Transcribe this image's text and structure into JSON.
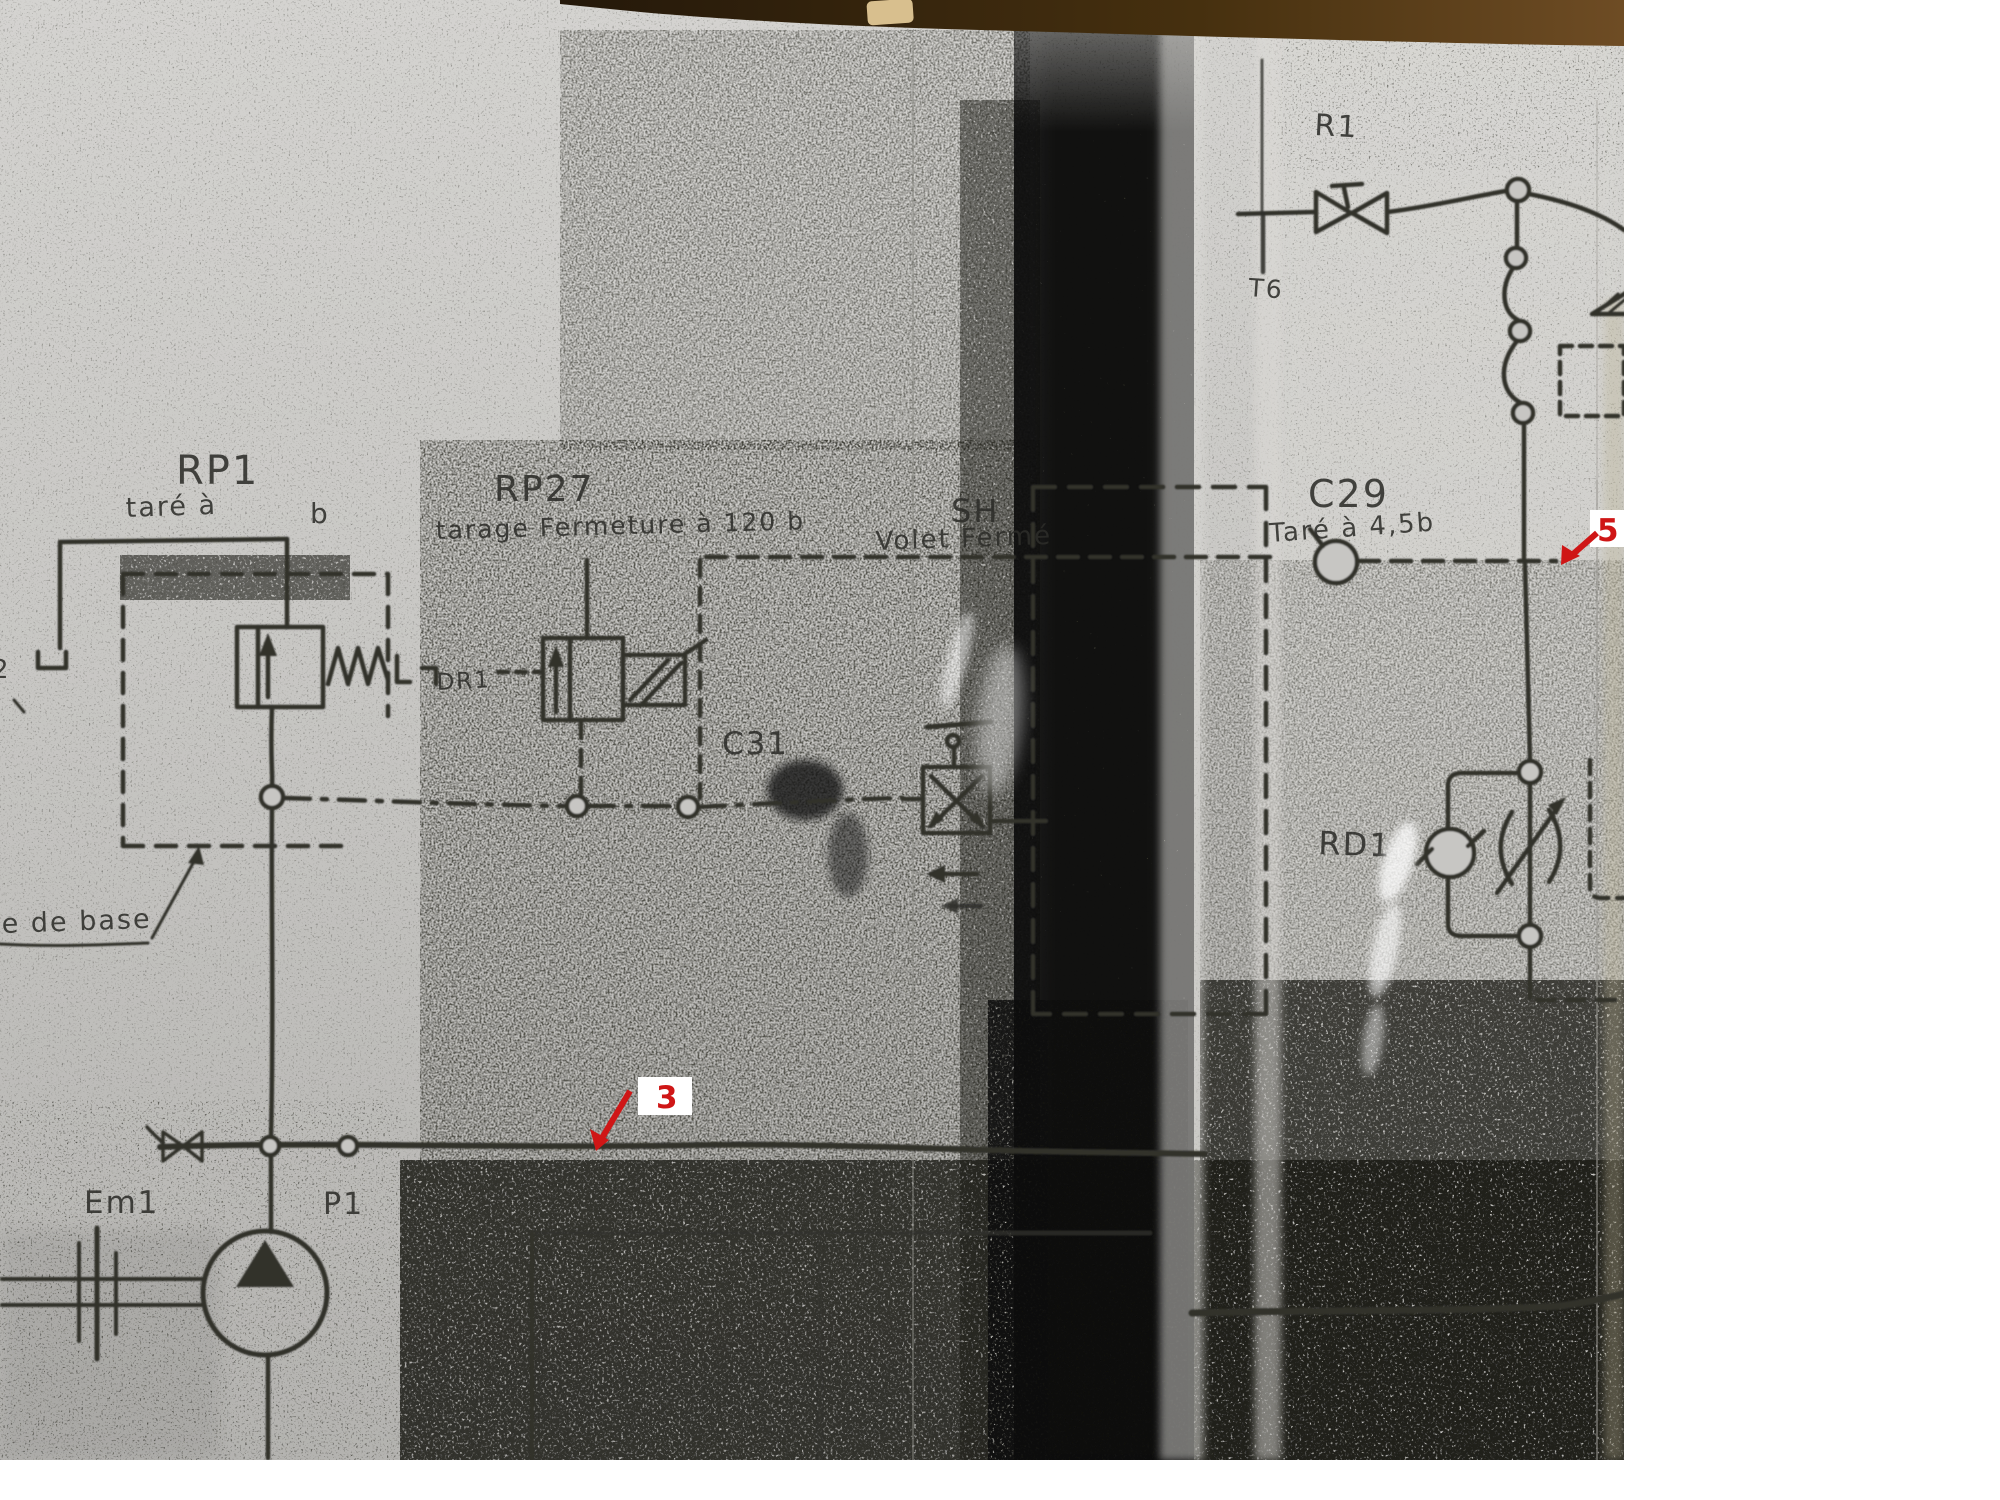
{
  "canvas": {
    "width": 2000,
    "height": 1500,
    "background_color": "#ffffff"
  },
  "photo": {
    "description": "photocopied hydraulic schematic sheet in plastic sleeve, heavy toner noise, dark vertical smudge band, brown shelf edge along top",
    "paper_color": "#c9c8c5",
    "ink_color": "#30302c",
    "smudge_band_color": "#141412",
    "top_edge_color": "#4a3414",
    "annotation_red": "#cf1616"
  },
  "labels": {
    "rp1": {
      "title": "RP1",
      "sub_left": "taré à",
      "sub_right": "b"
    },
    "rp27": {
      "title": "RP27",
      "sub": "tarage Fermeture à 120 b"
    },
    "sh": {
      "title": "SH",
      "sub": "Volet Fermé"
    },
    "c29": {
      "title": "C29",
      "sub": "Taré à 4,5b"
    },
    "c31": "C31",
    "dr1": "DR1",
    "r1": "R1",
    "t6": "T6",
    "rd1": "RD1",
    "em1": "Em1",
    "p1": "P1",
    "left_edge_partial": "2",
    "handwritten_note": "e de base"
  },
  "annotations": {
    "marker3": {
      "number": "3"
    },
    "marker5": {
      "number": "5"
    }
  },
  "components": [
    {
      "label": "RP1",
      "symbol": "pressure-relief-valve-with-spring"
    },
    {
      "label": "RP27",
      "symbol": "solenoid-operated-relief-valve"
    },
    {
      "label": "SH",
      "symbol": "push-button-valve-closed-position"
    },
    {
      "label": "C29",
      "symbol": "orifice-on-pilot-line"
    },
    {
      "label": "C31",
      "symbol": "pilot-line-junction"
    },
    {
      "label": "R1",
      "symbol": "manual-shutoff-valve"
    },
    {
      "label": "RD1",
      "symbol": "check-valve-with-variable-throttle"
    },
    {
      "label": "Em1",
      "symbol": "motor-pump-coupling"
    },
    {
      "label": "P1",
      "symbol": "fixed-displacement-pump"
    }
  ]
}
